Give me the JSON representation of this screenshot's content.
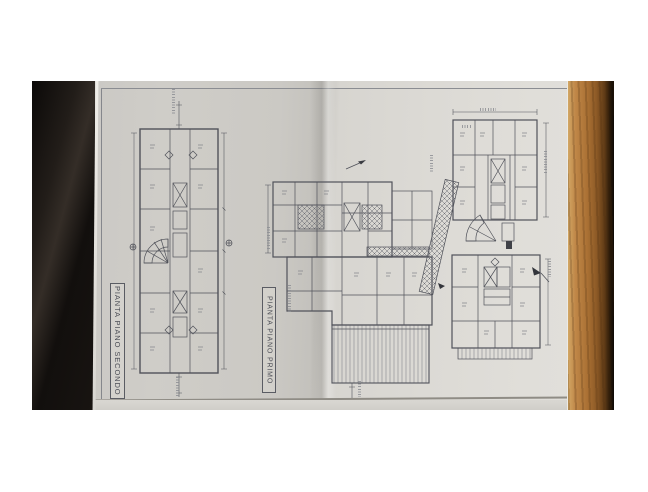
{
  "labels": {
    "plan_secondo": "PIANTA PIANO SECONDO",
    "plan_primo": "PIANTA PIANO PRIMO"
  },
  "colors": {
    "canvas_background": "#ffffff",
    "paper": "#d3d1cc",
    "paper_bright": "#dedcd7",
    "paper_shadow": "#c3c1bc",
    "drawing_ink": "#50525a",
    "dark_table_edge": "#14100d",
    "wood_light": "#c08748",
    "wood_dark": "#5e3a16",
    "wood_shadow": "#0d0905"
  }
}
